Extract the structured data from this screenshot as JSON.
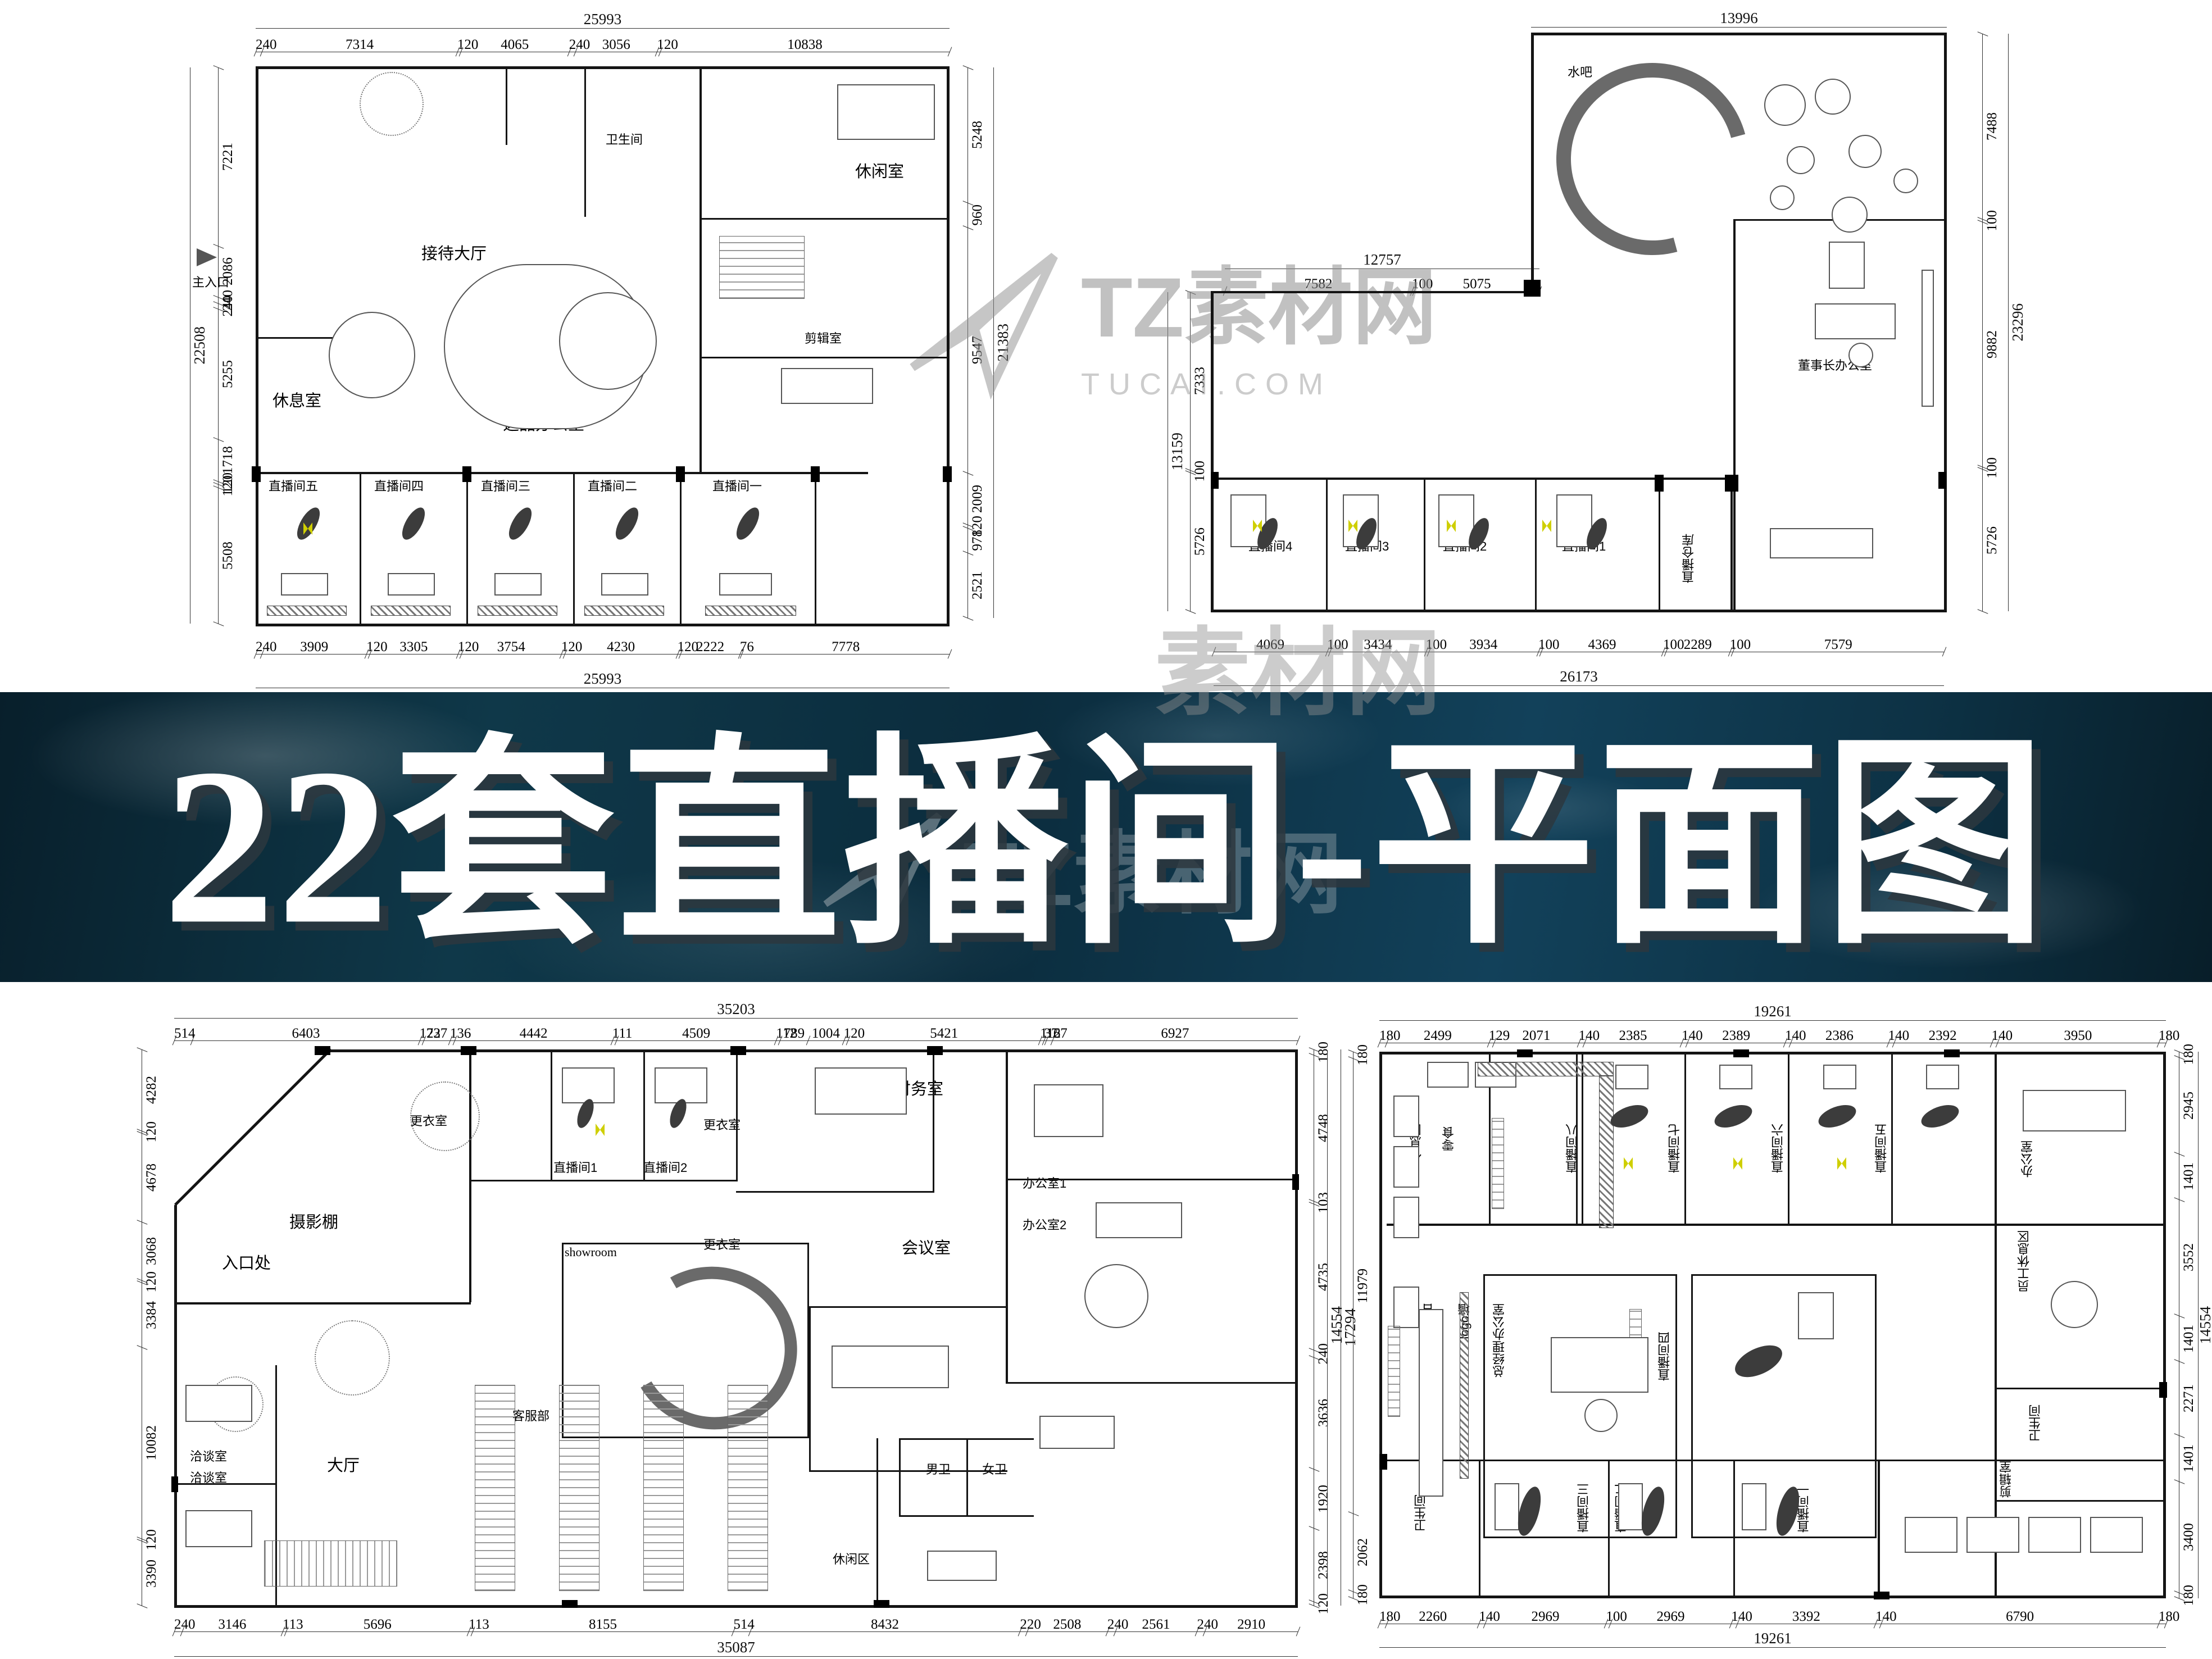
{
  "banner": {
    "title": "22套直播间-平面图"
  },
  "watermark": {
    "brand": "TZ素材网",
    "site": "TUCAI.COM",
    "partial": "素材网"
  },
  "plans": {
    "tl": {
      "total_top": "25993",
      "chain_top": [
        "240",
        "7314",
        "120",
        "4065",
        "240",
        "3056",
        "120",
        "10838"
      ],
      "total_bottom": "25993",
      "chain_bottom": [
        "240",
        "3909",
        "120",
        "3305",
        "120",
        "3754",
        "120",
        "4230",
        "120",
        "2222",
        "76",
        "7778"
      ],
      "total_left": "22508",
      "chain_left": [
        "7221",
        "2086",
        "240",
        "240",
        "5255",
        "1718",
        "120",
        "120",
        "5508"
      ],
      "total_right": "21383",
      "chain_right": [
        "5248",
        "960",
        "9547",
        "2009",
        "120",
        "978",
        "2521"
      ],
      "rooms": {
        "main_entrance": "主入口",
        "reception_hall": "接待大厅",
        "toilet": "卫生间",
        "lounge": "休闲室",
        "rest_room": "休息室",
        "selection_office": "选品办公室",
        "editing_room": "剪辑室",
        "office": "办公室",
        "live5": "直播间五",
        "live4": "直播间四",
        "live3": "直播间三",
        "live2": "直播间二",
        "live1": "直播间一"
      }
    },
    "tr": {
      "total_top": "13996",
      "sub_total": "12757",
      "sub_chain": [
        "7582",
        "100",
        "5075"
      ],
      "total_right": "23296",
      "chain_right": [
        "7488",
        "100",
        "9882",
        "100",
        "5726"
      ],
      "total_left": "13159",
      "chain_left": [
        "7333",
        "100",
        "5726"
      ],
      "total_bottom": "26173",
      "chain_bottom": [
        "4069",
        "100",
        "3434",
        "100",
        "3934",
        "100",
        "4369",
        "100",
        "2289",
        "100",
        "7579"
      ],
      "rooms": {
        "water_bar": "水吧",
        "live4": "直播间4",
        "live3": "直播间3",
        "live2": "直播间2",
        "live1": "直播间1",
        "warehouse": "直播仓库",
        "chairman_office": "董事长办公室"
      }
    },
    "bl": {
      "total_top": "35203",
      "chain_top": [
        "514",
        "6403",
        "122",
        "737",
        "136",
        "4442",
        "111",
        "4509",
        "112",
        "789",
        "1004",
        "120",
        "5421",
        "112",
        "37",
        "167",
        "6927"
      ],
      "total_bottom": "35087",
      "chain_bottom": [
        "240",
        "3146",
        "113",
        "5696",
        "113",
        "8155",
        "514",
        "8432",
        "220",
        "2508",
        "240",
        "2561",
        "240",
        "2910"
      ],
      "chain_left": [
        "4282",
        "120",
        "4678",
        "3068",
        "120",
        "3384",
        "10082",
        "120",
        "3390"
      ],
      "total_right": "17294",
      "chain_right": [
        "180",
        "4748",
        "103",
        "4735",
        "240",
        "3636",
        "1920",
        "2398",
        "120"
      ],
      "rooms": {
        "dressing1": "更衣室",
        "dressing2": "更衣室",
        "dressing3": "更衣室",
        "live1": "直播间1",
        "live2": "直播间2",
        "studio": "摄影棚",
        "entrance": "入口处",
        "showroom": "showroom",
        "finance": "财务室",
        "office1": "办公室1",
        "office2": "办公室2",
        "meeting": "会议室",
        "talk1": "洽谈室",
        "talk2": "洽谈室",
        "hall": "大厅",
        "service": "客服部",
        "leisure": "休闲区",
        "male_wc": "男卫",
        "female_wc": "女卫"
      }
    },
    "br": {
      "total_top": "19261",
      "chain_top": [
        "180",
        "2499",
        "129",
        "2071",
        "140",
        "2385",
        "140",
        "2389",
        "140",
        "2386",
        "140",
        "2392",
        "140",
        "3950",
        "180"
      ],
      "total_bottom": "19261",
      "chain_bottom": [
        "180",
        "2260",
        "140",
        "2969",
        "100",
        "2969",
        "140",
        "3392",
        "140",
        "6790",
        "180"
      ],
      "total_left": "14554",
      "chain_left": [
        "180",
        "11979",
        "2062",
        "180"
      ],
      "total_right": "14554",
      "chain_right": [
        "180",
        "2945",
        "1401",
        "3552",
        "1401",
        "2271",
        "1401",
        "3400",
        "180"
      ],
      "rooms": {
        "rest": "休息区",
        "snacks": "零食",
        "live8": "直播间八",
        "live7": "直播间七",
        "live6": "直播间六",
        "live5": "直播间五",
        "office": "办公室",
        "staff_rest": "员工休息区",
        "reception": "接待台",
        "logo_wall": "logo墙",
        "gm_office": "总经理办公室",
        "live4": "直播间四",
        "wc_left": "卫生间",
        "live3": "直播间三",
        "live2": "直播间二",
        "live1": "直播间一",
        "editing": "剪辑室",
        "wc_right": "卫生间"
      }
    }
  }
}
